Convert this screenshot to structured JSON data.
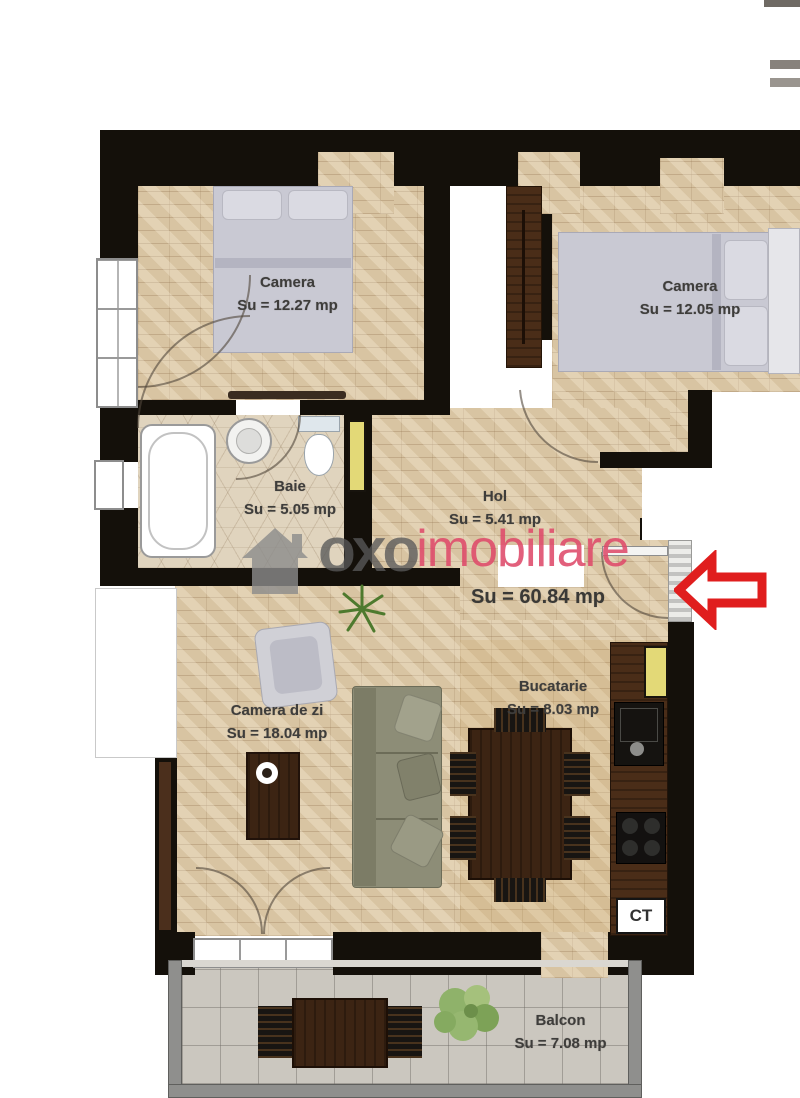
{
  "floorplan": {
    "total": {
      "label": "Su  = 60.84 mp"
    },
    "rooms": [
      {
        "id": "bedroom-1",
        "name": "Camera",
        "area": "Su  = 12.27 mp"
      },
      {
        "id": "bedroom-2",
        "name": "Camera",
        "area": "Su  = 12.05 mp"
      },
      {
        "id": "bathroom",
        "name": "Baie",
        "area": "Su  = 5.05 mp"
      },
      {
        "id": "hallway",
        "name": "Hol",
        "area": "Su  = 5.41 mp"
      },
      {
        "id": "living-room",
        "name": "Camera de zi",
        "area": "Su  = 18.04 mp"
      },
      {
        "id": "kitchen",
        "name": "Bucatarie",
        "area": "Su  = 8.03 mp"
      },
      {
        "id": "balcony",
        "name": "Balcon",
        "area": "Su  = 7.08 mp"
      }
    ],
    "labels": {
      "central_heating": "CT"
    },
    "watermark": {
      "brand": "oxo",
      "suffix": "imobiliare"
    },
    "colors": {
      "wall_black": "#14100a",
      "floor_brick": "#d8c4a2",
      "bath_tile": "#e0d4be",
      "balcony_tile": "#cbc7bf",
      "wood_dark": "#4a2d18",
      "door_yellow": "#e3d977",
      "arrow_red": "#e01e1e",
      "brand_pink": "#de4a6a",
      "bed_gray": "#c9c9d3",
      "sofa_olive": "#8d8d77"
    }
  }
}
